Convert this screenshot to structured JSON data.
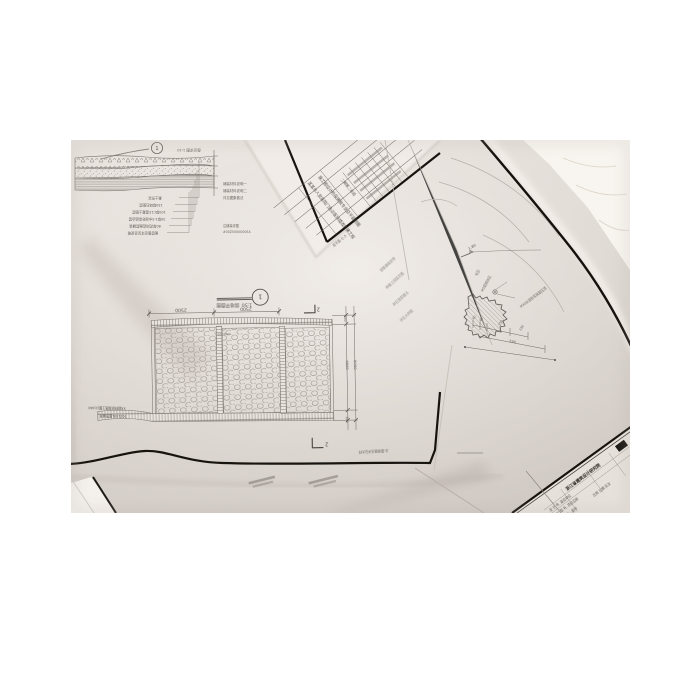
{
  "plan": {
    "title": "围墙平面图",
    "scale": "1:50",
    "detail_marker": "1",
    "section_marker_top": "2",
    "section_marker_bottom": "2",
    "dim_top_1": "2500",
    "dim_top_2": "2500",
    "dim_right_cap_top": "100",
    "dim_right_inner": "4800",
    "dim_right_outer": "5000",
    "dim_right_cap_bottom": "100",
    "rebar_note": "Ø6@200"
  },
  "pavement_section": {
    "detail_marker": "1",
    "caption": "做法详图 1:10",
    "labels": [
      "素土夯实",
      "150厚碎石垫层",
      "100厚C15混凝土垫层",
      "30厚1:3水泥砂浆结合层",
      "60厚花岗岩面层铺装",
      "面层做法详见总说明"
    ],
    "notes_right": [
      "铺装材料说明一",
      "铺装材料说明二",
      "详见图集做法"
    ],
    "notes_small": [
      "注铺装详图",
      "#00Z5000U005A"
    ]
  },
  "rockery_detail": {
    "level": "1.80",
    "dim_1": "40",
    "dim_2": "40",
    "dim_3": "250",
    "dim_4": "230",
    "dim_total": "530",
    "label_1": "毛石",
    "label_2": "M5浆砌块石",
    "label_3": "M30水泥砂浆抹面压顶",
    "side_notes": [
      "道路铺装说明",
      "种植土回填范围",
      "碎石垫层做法",
      "详见大样图"
    ]
  },
  "titleblock_sheet": {
    "project_line_1": "某某市人民医院门急诊医技楼改扩建工程",
    "project_line_2": "施工图设计阶段建筑专业总平面附图",
    "stage_label": "二期第二标段",
    "corner_note": "总平面 七-5"
  },
  "stamp_sheet": {
    "institute": "浙江省建筑设计研究院",
    "row_1": "设 计 号, 建设单位",
    "row_2": "工 程 号, 项目名称",
    "row_3": "图别 · 图号",
    "row_4": "比例 日期 页次"
  },
  "misc": {
    "bottom_note_1": "50Z1001图签编号",
    "bottom_note_2": "XX园林景观施工图(2)0A0",
    "plan_note": "注:围墙做法详见大样"
  }
}
